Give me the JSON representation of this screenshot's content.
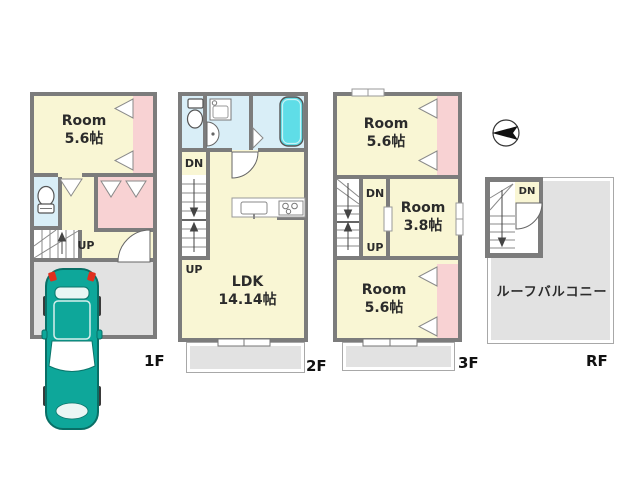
{
  "floors": {
    "f1": {
      "label": "1F",
      "room": {
        "name": "Room",
        "size": "5.6帖"
      },
      "stair_up": "UP"
    },
    "f2": {
      "label": "2F",
      "ldk": {
        "name": "LDK",
        "size": "14.14帖"
      },
      "stair_dn": "DN",
      "stair_up": "UP"
    },
    "f3": {
      "label": "3F",
      "room_north": {
        "name": "Room",
        "size": "5.6帖"
      },
      "room_mid": {
        "name": "Room",
        "size": "3.8帖"
      },
      "room_south": {
        "name": "Room",
        "size": "5.6帖"
      },
      "stair_dn": "DN",
      "stair_up": "UP"
    },
    "rf": {
      "label": "RF",
      "roof_balcony": "ルーフバルコニー",
      "stair_dn": "DN"
    }
  },
  "icons": {
    "compass": "compass-north-icon",
    "car": "car-top-view-icon",
    "toilet": "toilet-icon",
    "bathtub": "bathtub-icon",
    "washbasin": "washbasin-icon",
    "washing_machine": "washing-machine-icon",
    "stove": "stove-icon",
    "sink": "kitchen-sink-icon"
  },
  "colors": {
    "room_fill": "#f9f6d4",
    "closet_fill": "#f8d2d3",
    "wet_area_fill": "#d9eef7",
    "bathtub_fill": "#5fdde7",
    "outdoor_fill": "#e2e2e2",
    "wall": "#7c7c7c",
    "car_body": "#0ea79a",
    "car_light": "#df2f1e",
    "background": "#ffffff"
  }
}
